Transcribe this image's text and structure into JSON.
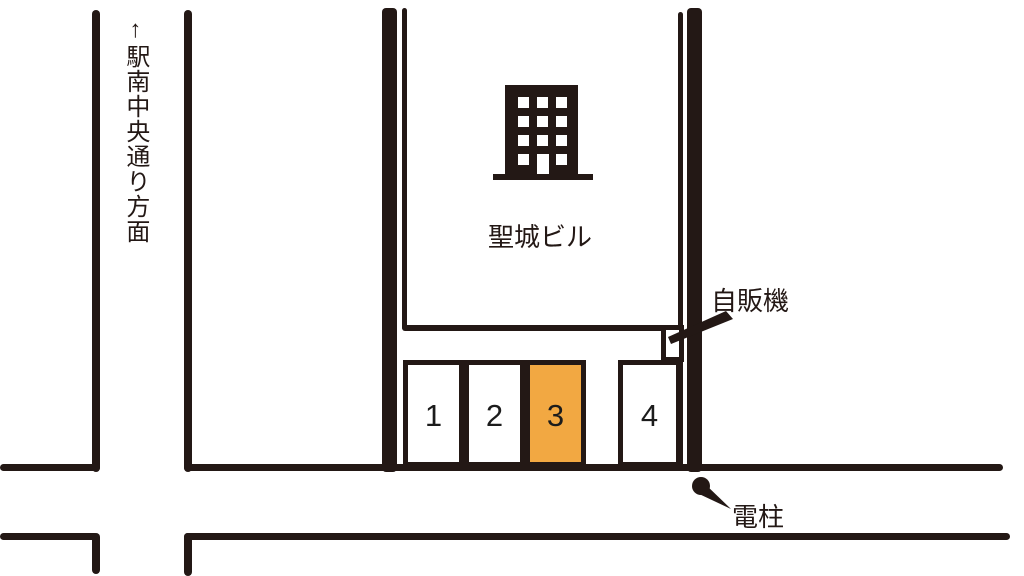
{
  "street_sign": {
    "label": "↑駅南中央通り方面"
  },
  "building": {
    "name": "聖城ビル"
  },
  "vending_machine": {
    "label": "自販機"
  },
  "utility_pole": {
    "label": "電柱"
  },
  "parking_spaces": [
    {
      "number": "1",
      "highlighted": false
    },
    {
      "number": "2",
      "highlighted": false
    },
    {
      "number": "3",
      "highlighted": true
    },
    {
      "number": "4",
      "highlighted": false
    }
  ],
  "colors": {
    "line": "#231815",
    "highlight": "#F2A842",
    "space_default": "#FFFFFF"
  }
}
